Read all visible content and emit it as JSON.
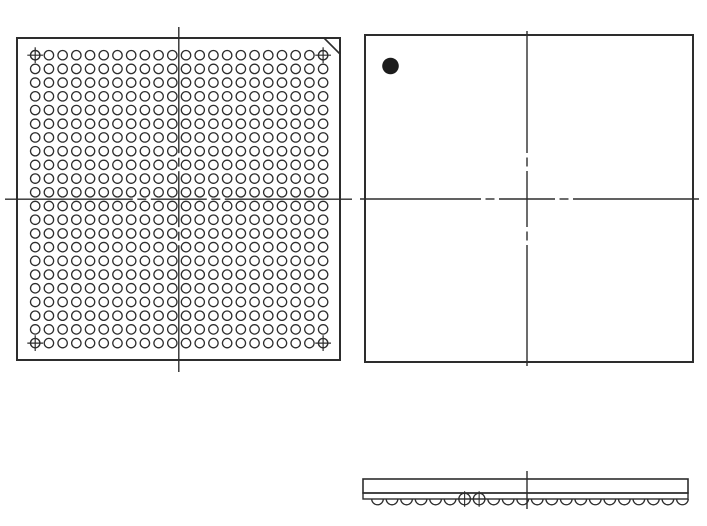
{
  "drawing": {
    "title": "bga-package-outline-drawing",
    "background_color": "#ffffff",
    "line_color": "#2d2d2d",
    "pin1_fill_color": "#1c1c1c",
    "views": {
      "bottom_view": {
        "label": "ball-grid-bottom-view",
        "outline": {
          "x": 17,
          "y": 38,
          "width": 323,
          "height": 322
        },
        "a1_chamfer": {
          "x1": 324,
          "y1": 38,
          "x2": 340,
          "y2": 54
        },
        "ball_grid": {
          "rows": 22,
          "cols": 22,
          "first_x": 35.2,
          "first_y": 55.2,
          "pitch_x": 13.71,
          "pitch_y": 13.71,
          "ball_radius": 4.7,
          "ball_count": 484
        },
        "corner_fiducials": [
          [
            0,
            0
          ],
          [
            21,
            0
          ],
          [
            0,
            21
          ],
          [
            21,
            21
          ]
        ],
        "fiducial_arm_extra": 3.2,
        "centerline_vertical": {
          "x": 178.8,
          "y1": 27,
          "y2": 372
        },
        "centerline_horizontal": {
          "y": 199.2,
          "x1": 5,
          "x2": 352
        }
      },
      "top_view": {
        "label": "package-top-view",
        "outline": {
          "x": 365,
          "y": 35,
          "width": 328,
          "height": 327
        },
        "pin1_dot": {
          "cx": 390.5,
          "cy": 66,
          "r": 8.3
        },
        "centerline_vertical": {
          "x": 527,
          "y1": 31,
          "y2": 366
        },
        "centerline_horizontal": {
          "y": 199,
          "x1": 360,
          "x2": 699
        }
      },
      "side_view": {
        "label": "package-side-view",
        "body": {
          "x": 363,
          "y": 479,
          "width": 325,
          "height": 14
        },
        "substrate": {
          "x": 363,
          "y": 493,
          "width": 325,
          "height": 6
        },
        "balls": {
          "count": 22,
          "first_cx": 377.5,
          "pitch": 14.52,
          "cy": 499,
          "radius": 5.8,
          "crossed_indices": [
            6,
            7
          ]
        },
        "centerline": {
          "x": 527,
          "y1": 471,
          "y2": 509
        }
      }
    },
    "centerline_pattern": {
      "center_half": 28,
      "gap": 4.5,
      "short_dash": 9
    }
  }
}
